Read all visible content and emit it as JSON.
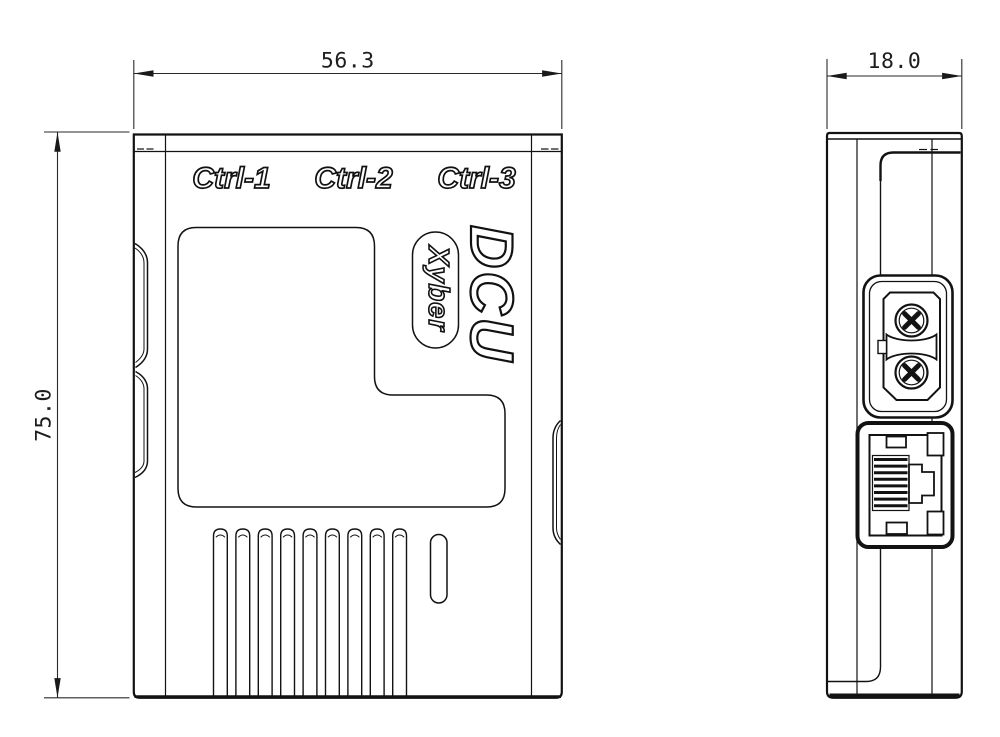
{
  "canvas": {
    "width": 1000,
    "height": 737,
    "background": "#ffffff",
    "line_color": "#121212",
    "dimension_color": "#2a2a2a"
  },
  "front_view": {
    "port_labels": [
      "Ctrl-1",
      "Ctrl-2",
      "Ctrl-3"
    ],
    "logo": "DCU",
    "brand": "Xyber",
    "vent_slot_count": 9
  },
  "side_view": {
    "connectors": [
      "xt30-power-connector",
      "rj45-ethernet-port"
    ]
  },
  "dimensions": {
    "width": "56.3",
    "height": "75.0",
    "depth": "18.0"
  }
}
